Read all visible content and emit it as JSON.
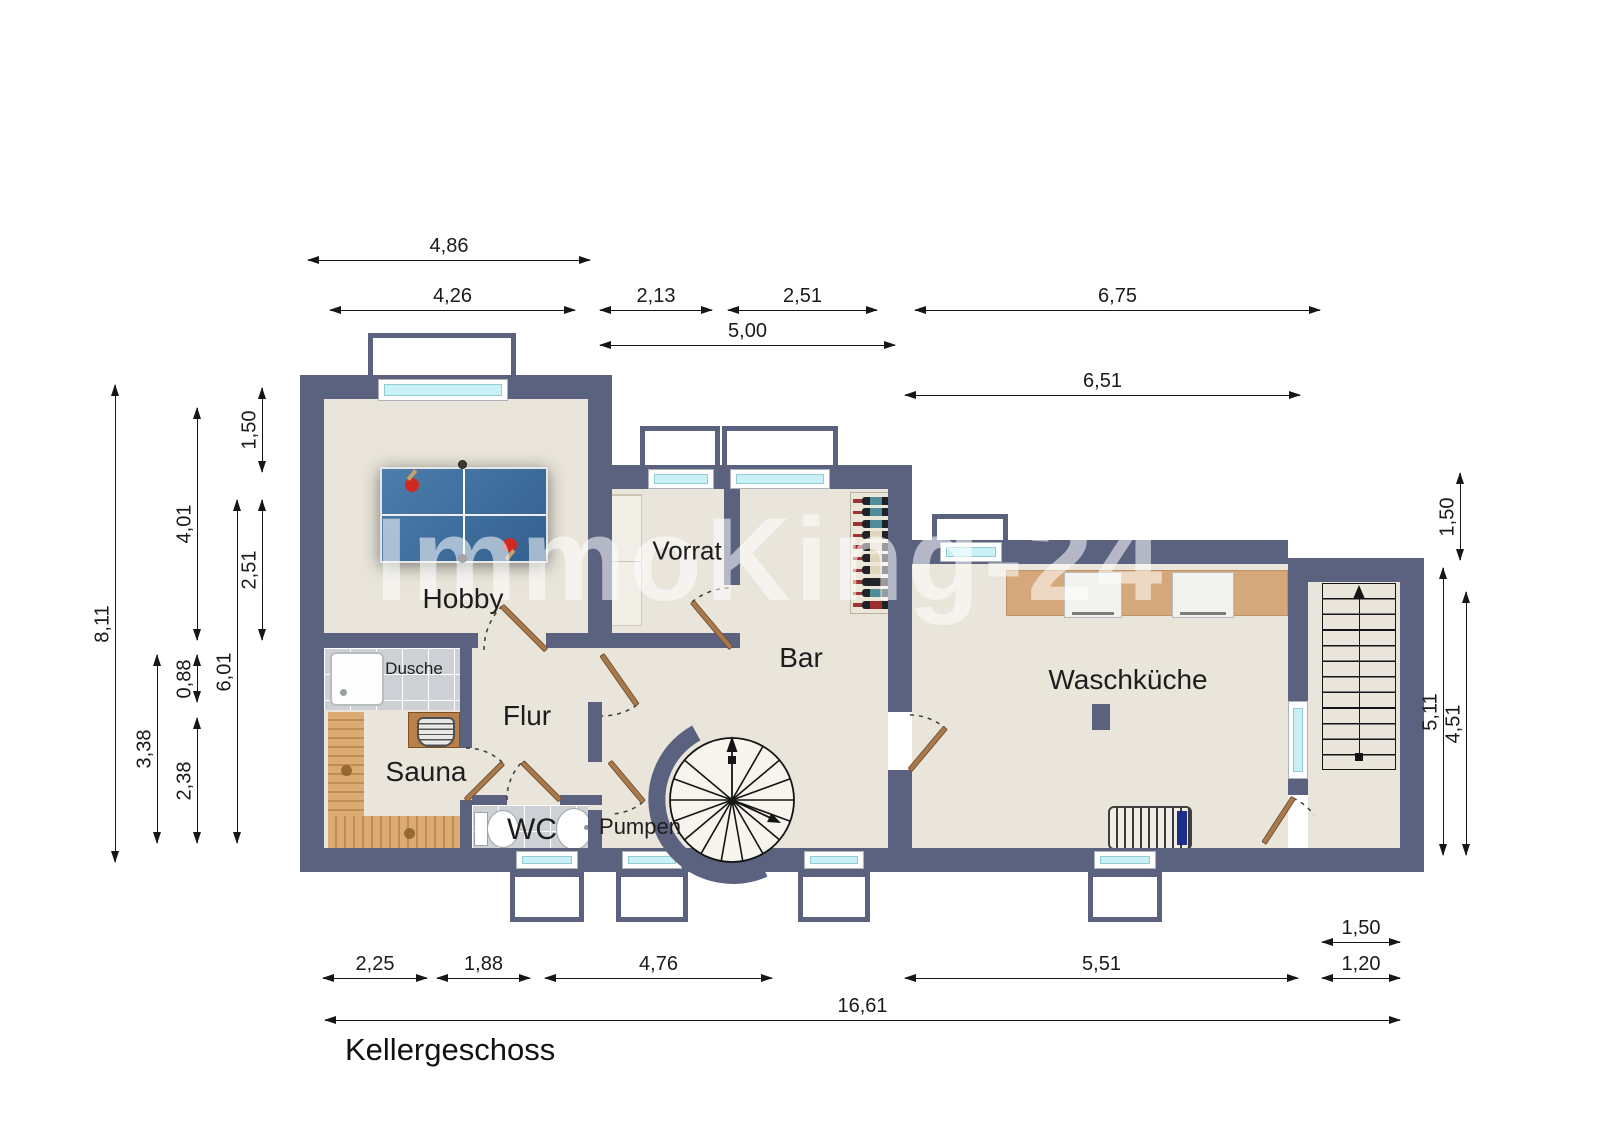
{
  "title": "Kellergeschoss",
  "watermark": "ImmoKing-24",
  "rooms": {
    "hobby": "Hobby",
    "vorrat": "Vorrat",
    "bar": "Bar",
    "waschkueche": "Waschküche",
    "flur": "Flur",
    "sauna": "Sauna",
    "dusche": "Dusche",
    "wc": "WC",
    "pumpen": "Pumpen"
  },
  "dimensions": {
    "top": [
      "4,86",
      "4,26",
      "2,13",
      "2,51",
      "6,75",
      "5,00",
      "6,51"
    ],
    "bottom": [
      "2,25",
      "1,88",
      "4,76",
      "5,51",
      "1,50",
      "1,20",
      "16,61"
    ],
    "left": [
      "8,11",
      "4,01",
      "1,50",
      "2,51",
      "6,01",
      "0,88",
      "3,38",
      "2,38"
    ],
    "right": [
      "1,50",
      "5,11",
      "4,51"
    ]
  },
  "furniture": [
    "table-tennis-table",
    "wine-rack",
    "storage-shelf",
    "spiral-staircase",
    "straight-staircase",
    "sauna-bench",
    "sauna-heater",
    "shower-tray",
    "toilet",
    "wash-basin",
    "counter",
    "washing-machines",
    "drying-rack",
    "column"
  ],
  "colors": {
    "wall": "#5a6280",
    "floor": "#e9e5da",
    "tile": "#cdd1d6",
    "window_glass": "#c9f1f5",
    "door": "#a9794e",
    "table_tennis": "#3f6d9d",
    "counter": "#d5a87b",
    "wood": "#d9a76f"
  }
}
